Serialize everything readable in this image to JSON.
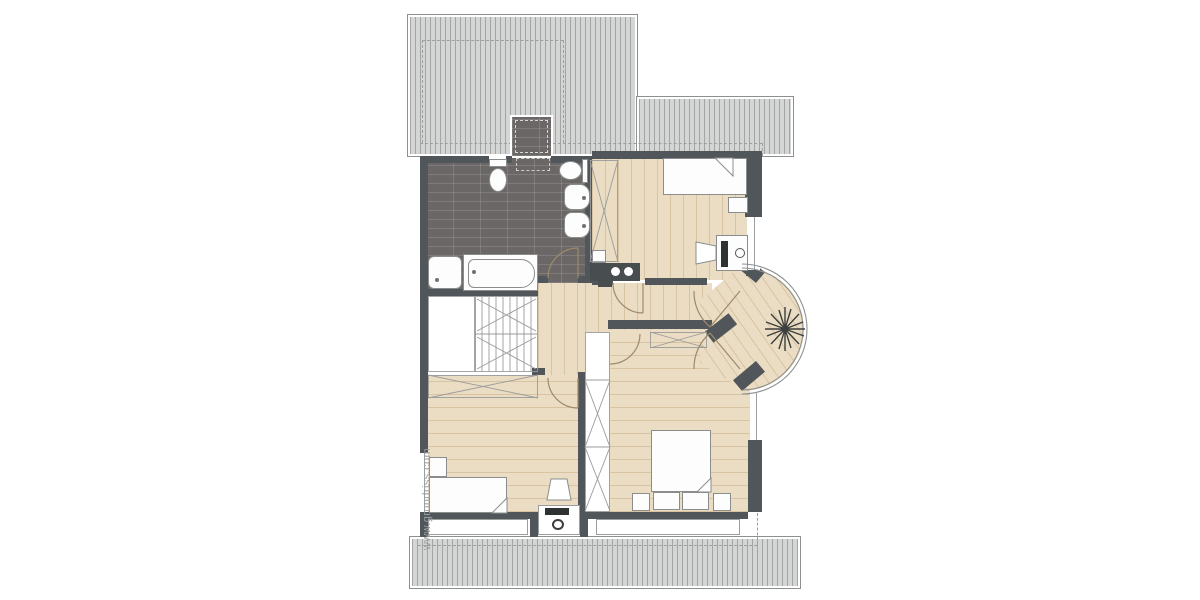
{
  "watermark": {
    "text": "www.grundriss.com"
  },
  "palette": {
    "wall": "#51565a",
    "roof_bg": "#d4d6d6",
    "roof_line": "#a3a5a5",
    "tile": "#6b6767",
    "tile_line": "rgba(255,255,255,0.13)",
    "wood": "#ebddc3",
    "wood_line": "rgba(160,120,65,0.25)",
    "fixture_line": "#8b8d8d",
    "door_arc": "#9c8a6a",
    "dash": "#9aa0a0",
    "plant": "#3c3f3e",
    "watermark_color": "#9aa1a1",
    "outline": "#8d9090"
  }
}
